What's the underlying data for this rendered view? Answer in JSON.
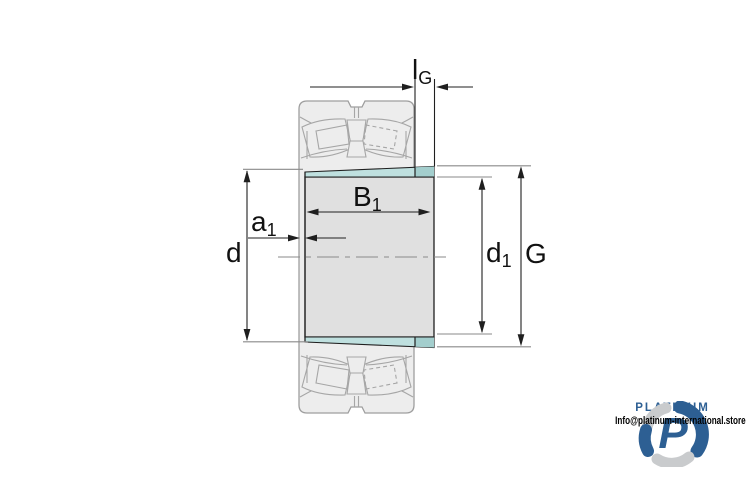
{
  "page": {
    "background": "#ffffff"
  },
  "diagram": {
    "type": "bearing-adapter-sleeve-technical-drawing",
    "labels": {
      "lg": {
        "base": "l",
        "sub": "G"
      },
      "b1": {
        "base": "B",
        "sub": "1"
      },
      "a1": {
        "base": "a",
        "sub": "1"
      },
      "d": {
        "base": "d",
        "sub": ""
      },
      "d1": {
        "base": "d",
        "sub": "1"
      },
      "g": {
        "base": "G",
        "sub": ""
      }
    },
    "colors": {
      "line_dark": "#1f1f1f",
      "extension_gray": "#8a8a8a",
      "detail_gray": "#a6a6a6",
      "bearing_gray": "#ededed",
      "bearing_stroke": "#9e9e9e",
      "body_gray": "#e0e0e0",
      "sleeve_teal": "#bfe0df",
      "sleeve_teal_dark": "#a3cecd"
    }
  },
  "branding": {
    "name": "PLATINUM",
    "email": "Info@platinum-international.store",
    "colors": {
      "brand_blue": "#2d5f93",
      "brand_silver": "#c9cbcd",
      "text_black": "#000000"
    }
  }
}
